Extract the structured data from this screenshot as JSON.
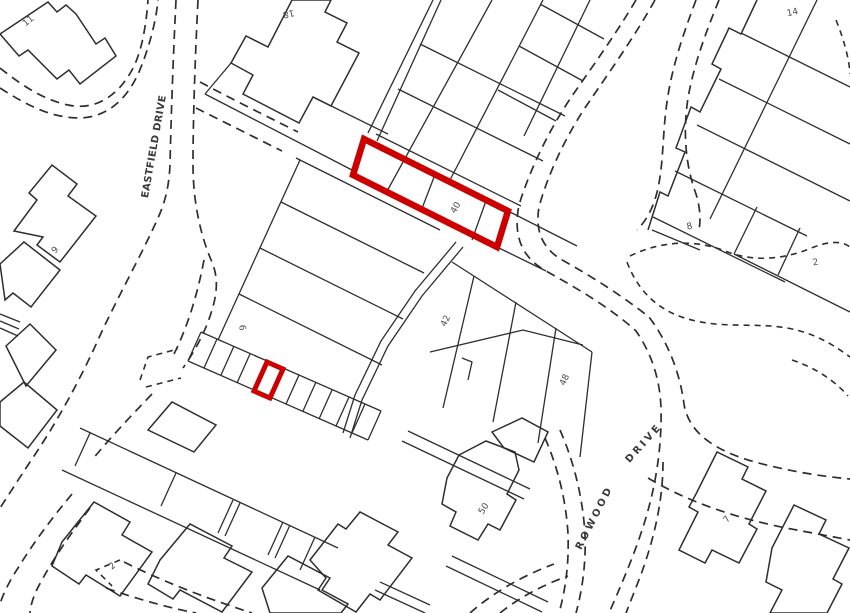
{
  "map": {
    "background": "#ffffff",
    "line_color": "#2e2e2e",
    "label_color": "#4d4d4d",
    "highlight_color": "#cc0000",
    "street_labels": [
      {
        "id": "eastfield-drive",
        "text": "EASTFIELD DRIVE",
        "x": 157,
        "y": 147,
        "rotation": -80,
        "ls": 0.4,
        "fs": 9.5
      },
      {
        "id": "rowood",
        "text": "ROWOOD",
        "x": 597,
        "y": 519,
        "rotation": -63,
        "ls": 3,
        "fs": 10
      },
      {
        "id": "rowood-drive",
        "text": "DRIVE",
        "x": 646,
        "y": 445,
        "rotation": -48,
        "ls": 3,
        "fs": 10
      }
    ],
    "plot_labels": [
      {
        "id": "11",
        "text": "11",
        "x": 30,
        "y": 23,
        "rotation": -40
      },
      {
        "id": "18",
        "text": "18",
        "x": 288,
        "y": 11,
        "rotation": 168
      },
      {
        "id": "14",
        "text": "14",
        "x": 793,
        "y": 15,
        "rotation": -12
      },
      {
        "id": "9-west",
        "text": "9",
        "x": 57,
        "y": 252,
        "rotation": -45
      },
      {
        "id": "8",
        "text": "8",
        "x": 690,
        "y": 229,
        "rotation": -12
      },
      {
        "id": "2-northeast",
        "text": "2",
        "x": 816,
        "y": 265,
        "rotation": -10
      },
      {
        "id": "40",
        "text": "40",
        "x": 458,
        "y": 209,
        "rotation": -60
      },
      {
        "id": "9-central",
        "text": "9",
        "x": 246,
        "y": 327,
        "rotation": -100
      },
      {
        "id": "42",
        "text": "42",
        "x": 448,
        "y": 322,
        "rotation": -65
      },
      {
        "id": "48",
        "text": "48",
        "x": 567,
        "y": 381,
        "rotation": -65
      },
      {
        "id": "50",
        "text": "50",
        "x": 486,
        "y": 510,
        "rotation": -58
      },
      {
        "id": "2-southwest",
        "text": "2",
        "x": 114,
        "y": 568,
        "rotation": -40
      },
      {
        "id": "7",
        "text": "7",
        "x": 729,
        "y": 521,
        "rotation": -50
      }
    ]
  }
}
